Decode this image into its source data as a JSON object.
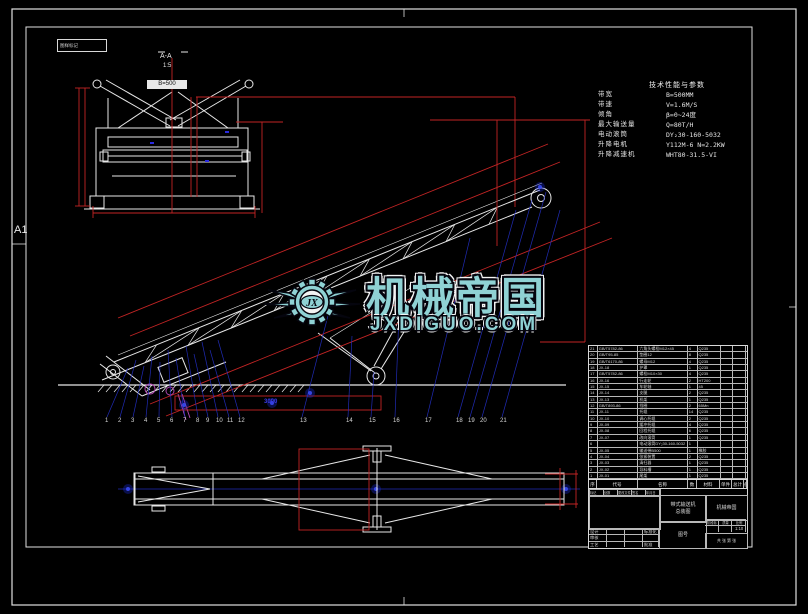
{
  "sheet": {
    "size_label": "A1",
    "corner_box_text": "图样标记"
  },
  "section_view": {
    "label": "A-A",
    "scale": "1:5",
    "belt_tag": "B=500"
  },
  "tech_table": {
    "title": "技术性能与参数",
    "rows": [
      {
        "label": "带宽",
        "value": "B=500MM"
      },
      {
        "label": "带速",
        "value": "V=1.6M/S"
      },
      {
        "label": "倾角",
        "value": "β=0~24度"
      },
      {
        "label": "最大输送量",
        "value": "Q=80T/H"
      },
      {
        "label": "电动滚筒",
        "value": "DY₂30-160-5032"
      },
      {
        "label": "升降电机",
        "value": "Y112M-6 N=2.2KW"
      },
      {
        "label": "升降减速机",
        "value": "WHT80-31.5-VI"
      }
    ]
  },
  "watermark": {
    "logo_initials": "JX",
    "title": "机械帝国",
    "domain": "JXDIGUO.COM",
    "teal": "#8fd2d4"
  },
  "callouts": {
    "numbers": [
      "1",
      "2",
      "3",
      "4",
      "5",
      "6",
      "7",
      "8",
      "9",
      "10",
      "11",
      "12",
      "13",
      "14",
      "15",
      "16",
      "17",
      "18",
      "19",
      "20",
      "21"
    ]
  },
  "dims": {
    "tail_span": "3000"
  },
  "bom": {
    "header": [
      "序号",
      "代号",
      "名称",
      "数量",
      "材料",
      "单件",
      "总计",
      "备注"
    ],
    "rows": [
      [
        "21",
        "GB/T5782-86",
        "六角头螺栓M12×45",
        "4",
        "Q235",
        "",
        "",
        ""
      ],
      [
        "20",
        "GB/T95-85",
        "垫圈12",
        "8",
        "Q235",
        "",
        "",
        ""
      ],
      [
        "19",
        "GB/T6170-86",
        "螺母M12",
        "4",
        "Q235",
        "",
        "",
        ""
      ],
      [
        "18",
        "JX-18",
        "护罩",
        "1",
        "Q235",
        "",
        "",
        ""
      ],
      [
        "17",
        "GB/T5782-86",
        "螺栓M10×30",
        "4",
        "Q235",
        "",
        "",
        ""
      ],
      [
        "16",
        "JX-16",
        "行走轮",
        "2",
        "HT200",
        "",
        "",
        ""
      ],
      [
        "15",
        "JX-15",
        "车轮轴",
        "1",
        "45",
        "",
        "",
        ""
      ],
      [
        "14",
        "JX-14",
        "支腿",
        "2",
        "Q235",
        "",
        "",
        ""
      ],
      [
        "13",
        "JX-13",
        "机架",
        "1",
        "Q235",
        "",
        "",
        ""
      ],
      [
        "12",
        "GB/T893-86",
        "挡圈",
        "2",
        "65Mn",
        "",
        "",
        ""
      ],
      [
        "11",
        "JX-11",
        "托辊",
        "14",
        "Q235",
        "",
        "",
        ""
      ],
      [
        "10",
        "JX-10",
        "调心托辊",
        "2",
        "Q235",
        "",
        "",
        ""
      ],
      [
        "9",
        "JX-09",
        "缓冲托辊",
        "4",
        "Q235",
        "",
        "",
        ""
      ],
      [
        "8",
        "JX-08",
        "回程托辊",
        "6",
        "Q235",
        "",
        "",
        ""
      ],
      [
        "7",
        "JX-07",
        "改向滚筒",
        "1",
        "Q235",
        "",
        "",
        ""
      ],
      [
        "6",
        "",
        "电动滚筒DY₂30-160-5032",
        "1",
        "",
        "",
        "",
        ""
      ],
      [
        "5",
        "JX-05",
        "输送带B500",
        "1",
        "橡胶",
        "",
        "",
        ""
      ],
      [
        "4",
        "JX-04",
        "张紧装置",
        "2",
        "Q235",
        "",
        "",
        ""
      ],
      [
        "3",
        "JX-03",
        "清扫器",
        "1",
        "Q235",
        "",
        "",
        ""
      ],
      [
        "2",
        "JX-02",
        "导料槽",
        "1",
        "Q235",
        "",
        "",
        ""
      ],
      [
        "1",
        "JX-01",
        "尾架",
        "1",
        "Q235",
        "",
        "",
        ""
      ]
    ]
  },
  "title_block": {
    "revision_cells": [
      "标记",
      "处数",
      "更改文件号",
      "签名",
      "年月日"
    ],
    "signature_rows": [
      {
        "label": "设计",
        "extra": "标准化"
      },
      {
        "label": "审核",
        "extra": ""
      },
      {
        "label": "工艺",
        "extra": "批准"
      }
    ],
    "drawing_title_line1": "带式输送机",
    "drawing_title_line2": "总装图",
    "company": "机械帝国",
    "drawing_no_label": "图号",
    "stage_labels": [
      "阶段标记",
      "质量",
      "比例"
    ],
    "scale_value": "1:10",
    "sheet_note": "共 张 第 张"
  }
}
